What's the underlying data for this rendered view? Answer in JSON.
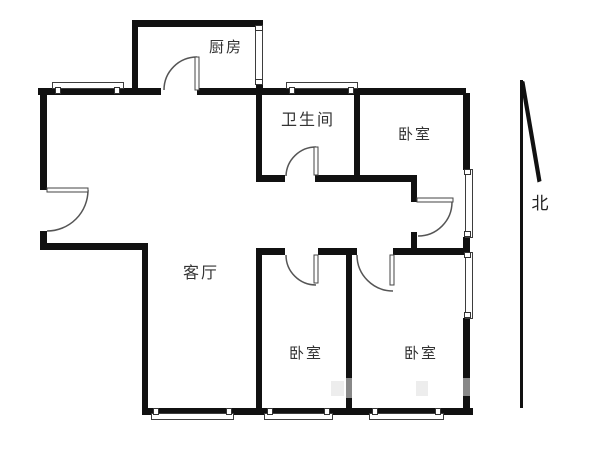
{
  "page": {
    "type": "apartment-floor-plan",
    "background": "#ffffff"
  },
  "colors": {
    "wall": "#111111",
    "thin_line": "#3d3d3d",
    "door_arc": "#555555",
    "label_text": "#333333"
  },
  "rooms": [
    {
      "name": "kitchen",
      "label": "厨房"
    },
    {
      "name": "bathroom",
      "label": "卫生间"
    },
    {
      "name": "bedroom-northeast",
      "label": "卧室"
    },
    {
      "name": "living-room",
      "label": "客厅"
    },
    {
      "name": "bedroom-south-middle",
      "label": "卧室"
    },
    {
      "name": "bedroom-southeast",
      "label": "卧室"
    }
  ],
  "compass": {
    "label": "北",
    "direction": "north-arrow"
  }
}
